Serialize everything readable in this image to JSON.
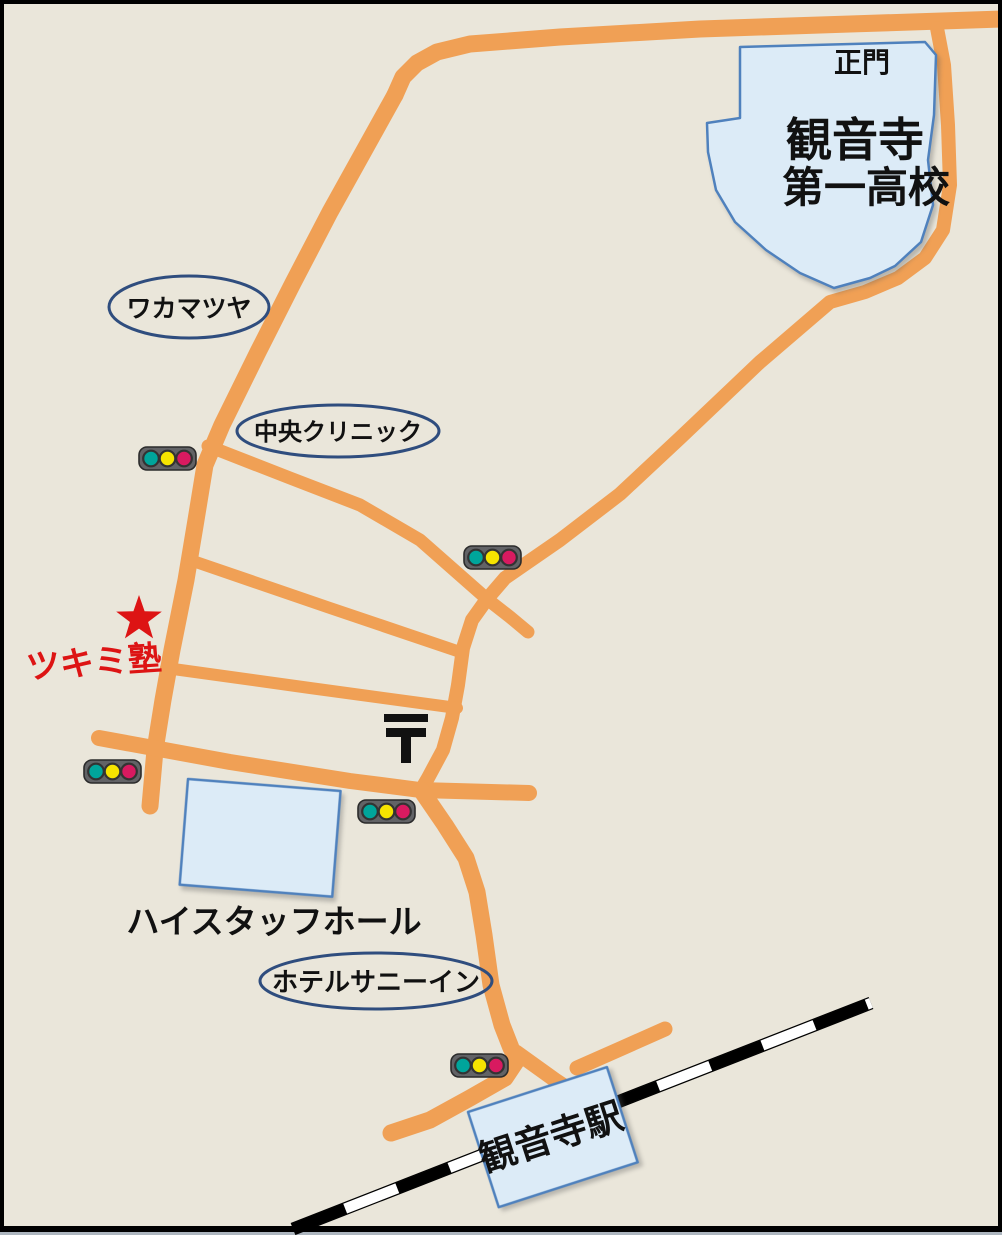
{
  "map": {
    "title": "hand-drawn access map to Tsukimi Juku",
    "labels": {
      "school_gate": "正門",
      "school_line1": "観音寺",
      "school_line2": "第一高校",
      "wakamatsuya": "ワカマツヤ",
      "chuo_clinic": "中央クリニック",
      "tsukimi_juku": "ツキミ塾",
      "high_staff_hall": "ハイスタッフホール",
      "hotel_sunny_inn": "ホテルサニーイン",
      "kanonji_station": "観音寺駅"
    },
    "icons": {
      "traffic_light_count": 5,
      "star": "location marker for Tsukimi Juku",
      "postal_mark": "〒"
    }
  },
  "colors": {
    "road": "#F0A055",
    "map-bg": "#EAE6DA",
    "building-fill": "#DCEBF7",
    "building-border": "#4F81BD",
    "ellipse-border": "#2F4D7E",
    "accent-red": "#DD1414",
    "signal-teal": "#00A59B",
    "signal-yellow": "#F6E400",
    "signal-pink": "#D81A60",
    "railway-black": "#000000",
    "text-black": "#111111"
  }
}
